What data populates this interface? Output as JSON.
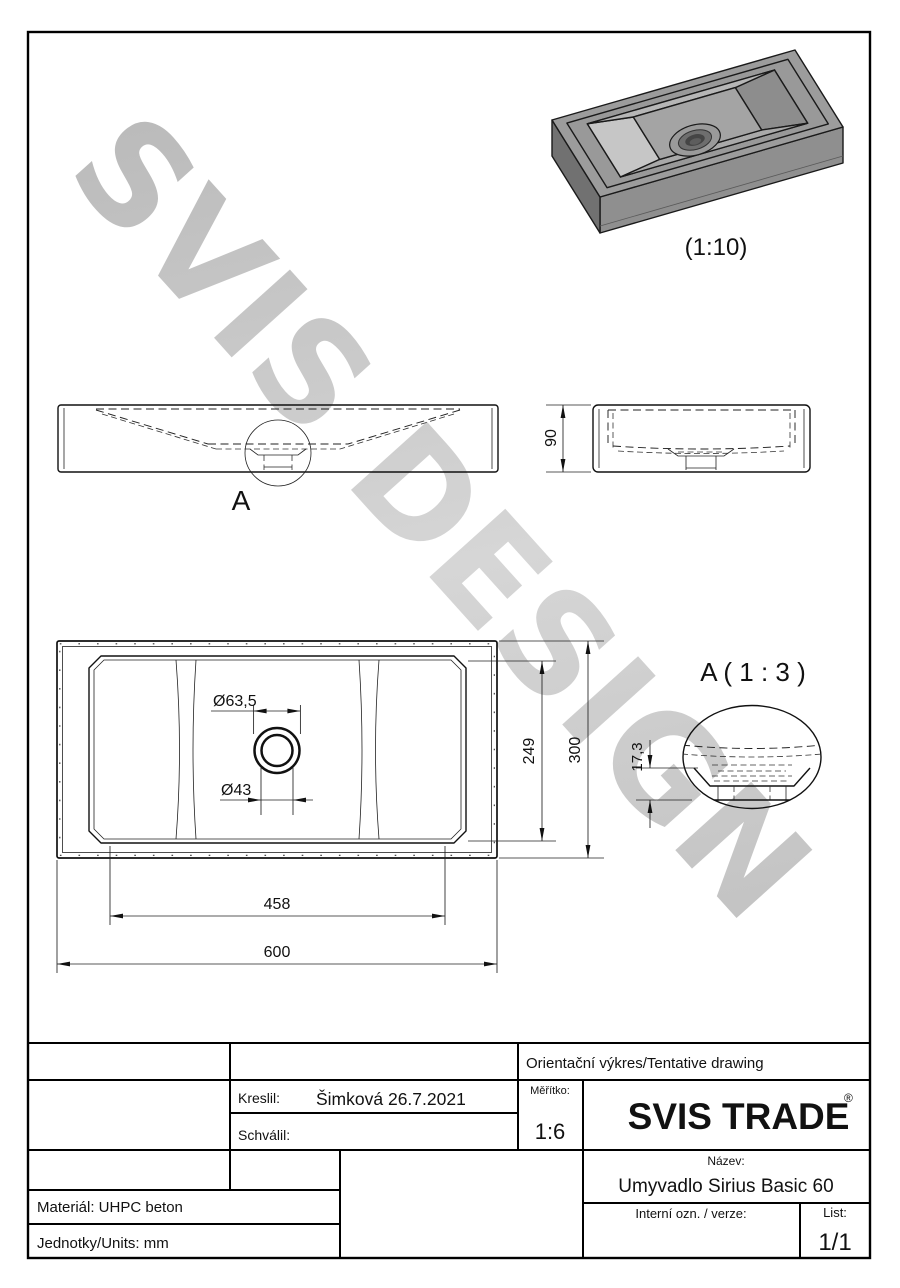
{
  "watermark": {
    "text": "SVIS DESIGN"
  },
  "labels": {
    "iso_scale": "(1:10)",
    "detail_ref": "A",
    "detail_title": "A ( 1 : 3 )"
  },
  "dims": {
    "d90": "90",
    "d249": "249",
    "d300": "300",
    "d458": "458",
    "d600": "600",
    "drain_outer": "Ø63,5",
    "drain_inner": "Ø43",
    "d173": "17,3"
  },
  "title_block": {
    "row1": "Orientační výkres/Tentative drawing",
    "kreslil_label": "Kreslil:",
    "kreslil_value": "Šimková 26.7.2021",
    "schvalil_label": "Schválil:",
    "scale_label": "Měřítko:",
    "scale_value": "1:6",
    "logo_svis": "SVIS",
    "logo_trade": "TRADE",
    "logo_reg": "®",
    "nazev_label": "Název:",
    "nazev_value": "Umyvadlo Sirius Basic 60",
    "interni_label": "Interní ozn. / verze:",
    "list_label": "List:",
    "list_value": "1/1",
    "material": "Materiál: UHPC beton",
    "units": "Jednotky/Units: mm"
  },
  "colors": {
    "accent": "#F2A71B",
    "line": "#111111",
    "watermark_gray": "#c7c7c7"
  }
}
